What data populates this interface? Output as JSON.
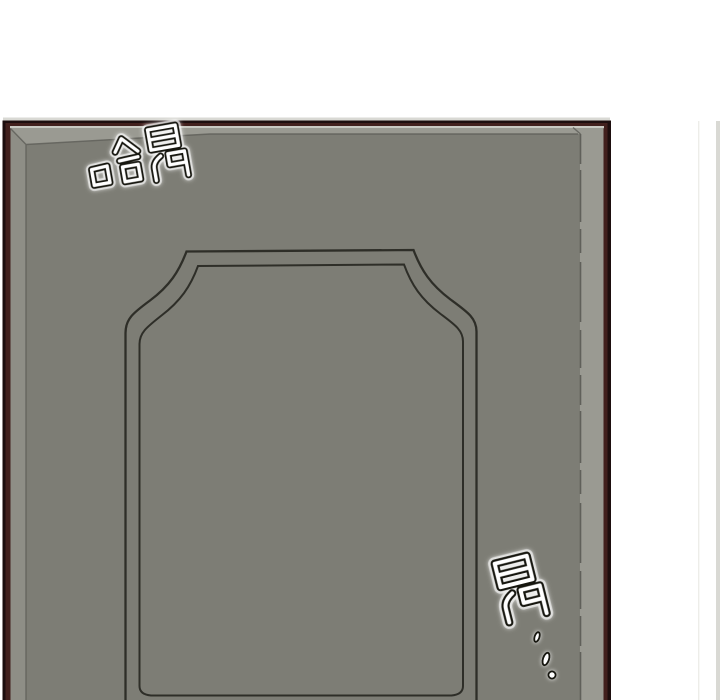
{
  "panel": {
    "type": "comic-door-panel",
    "background_color": "#ffffff"
  },
  "door": {
    "outline_dark": "#1d0e0e",
    "frame_maroon": "#42201d",
    "top_highlight": "#d9d9d4",
    "under_frame_highlight": "#c9c9c2",
    "bevel_light": "#9a9a92",
    "bevel_left": "#8e8e86",
    "face": "#7d7d75",
    "panel_line": "#2e2e28",
    "edge_line": "#60605a"
  },
  "wall": {
    "strip_color": "#d9d9d4",
    "hairline_color": "#ededE9"
  },
  "sfx": {
    "top": {
      "text": "哈昂",
      "fill": "#ffffff",
      "outline": "#16160f"
    },
    "bottom": {
      "text": "昂",
      "trail": "…",
      "trail_dot_count": 3,
      "fill": "#ffffff",
      "outline": "#16160f"
    }
  }
}
